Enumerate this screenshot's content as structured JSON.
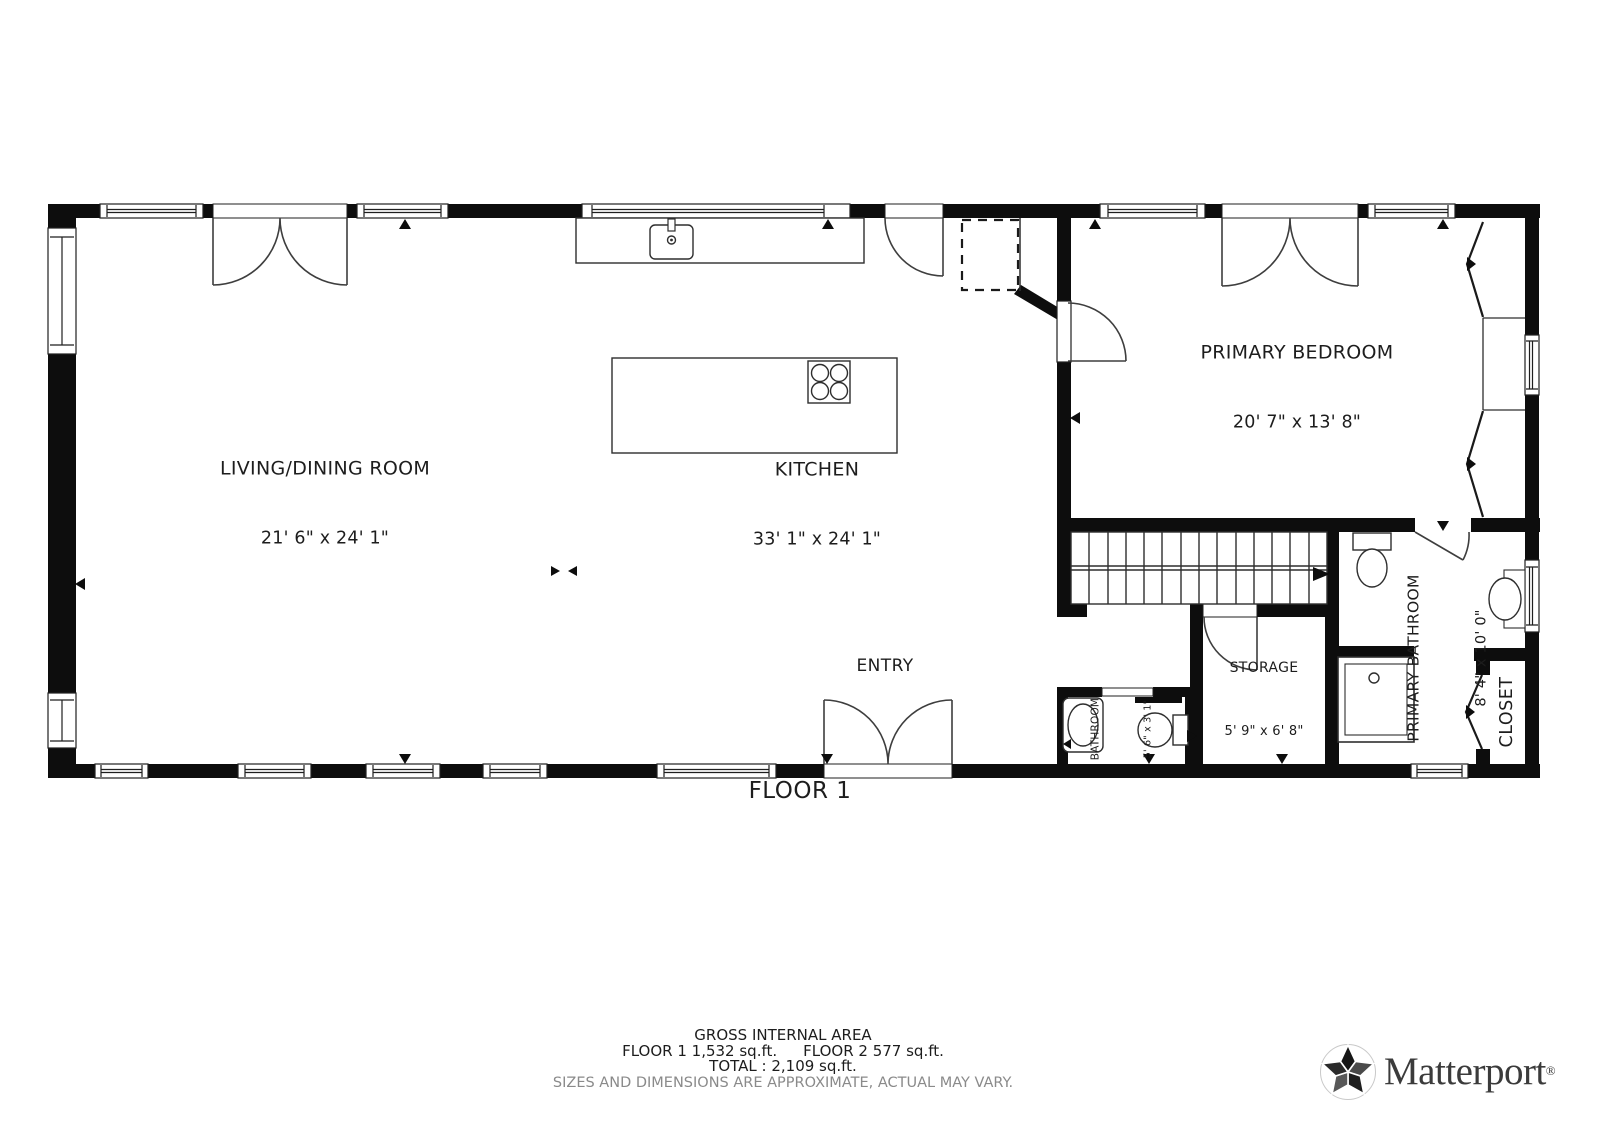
{
  "floor": {
    "label": "FLOOR 1"
  },
  "rooms": {
    "living_dining": {
      "name": "LIVING/DINING ROOM",
      "dims": "21' 6\" x 24' 1\""
    },
    "kitchen": {
      "name": "KITCHEN",
      "dims": "33' 1\" x 24' 1\""
    },
    "primary_bedroom": {
      "name": "PRIMARY BEDROOM",
      "dims": "20' 7\" x 13' 8\""
    },
    "entry": {
      "name": "ENTRY"
    },
    "storage": {
      "name": "STORAGE",
      "dims": "5' 9\" x 6' 8\""
    },
    "bathroom": {
      "name": "BATHROOM",
      "dims": "5' 6\" x 3' 1\""
    },
    "primary_bathroom": {
      "name": "PRIMARY BATHROOM",
      "dims": "8' 4\" x 10' 0\""
    },
    "closet": {
      "name": "CLOSET"
    }
  },
  "footer": {
    "title": "GROSS INTERNAL AREA",
    "floor1_area": "FLOOR 1 1,532 sq.ft.",
    "floor2_area": "FLOOR 2 577 sq.ft.",
    "total": "TOTAL :  2,109 sq.ft.",
    "disclaimer": "SIZES AND DIMENSIONS ARE APPROXIMATE, ACTUAL MAY VARY."
  },
  "branding": {
    "name": "Matterport",
    "registered": "®"
  },
  "colors": {
    "wall": "#0d0d0d",
    "thin_line": "#2e2e2e",
    "door_arc": "#3e3e3e",
    "text": "#1d1d1d",
    "disclaimer_text": "#8a8a8a",
    "logo_text": "#3b3b3b"
  }
}
